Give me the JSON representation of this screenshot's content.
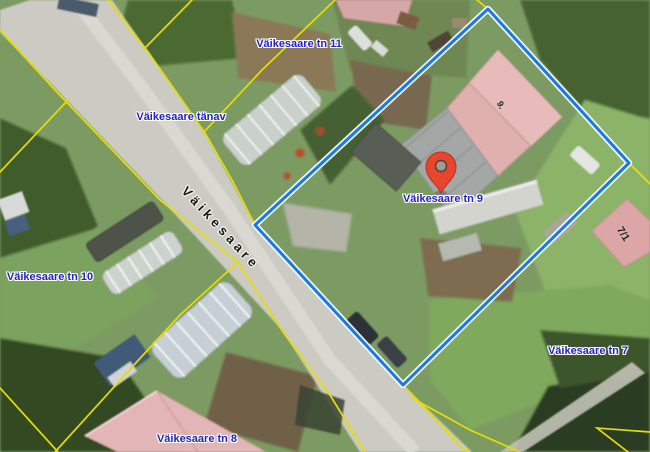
{
  "map": {
    "road_label": "Väikesaare",
    "labels": [
      {
        "id": "tn11",
        "text": "Väikesaare tn 11"
      },
      {
        "id": "tanav",
        "text": "Väikesaare tänav"
      },
      {
        "id": "tn10",
        "text": "Väikesaare tn 10"
      },
      {
        "id": "tn9",
        "text": "Väikesaare tn 9"
      },
      {
        "id": "tn7",
        "text": "Väikesaare tn 7"
      },
      {
        "id": "tn8",
        "text": "Väikesaare tn 8"
      }
    ],
    "building_labels": {
      "house_9": "9.",
      "house_7_1": "7/1"
    },
    "colors": {
      "cadastral_line": "#e8dc00",
      "selected_parcel_outline": "#1a7ae2",
      "label_text": "#2121cd",
      "marker": "#e8452e"
    }
  }
}
